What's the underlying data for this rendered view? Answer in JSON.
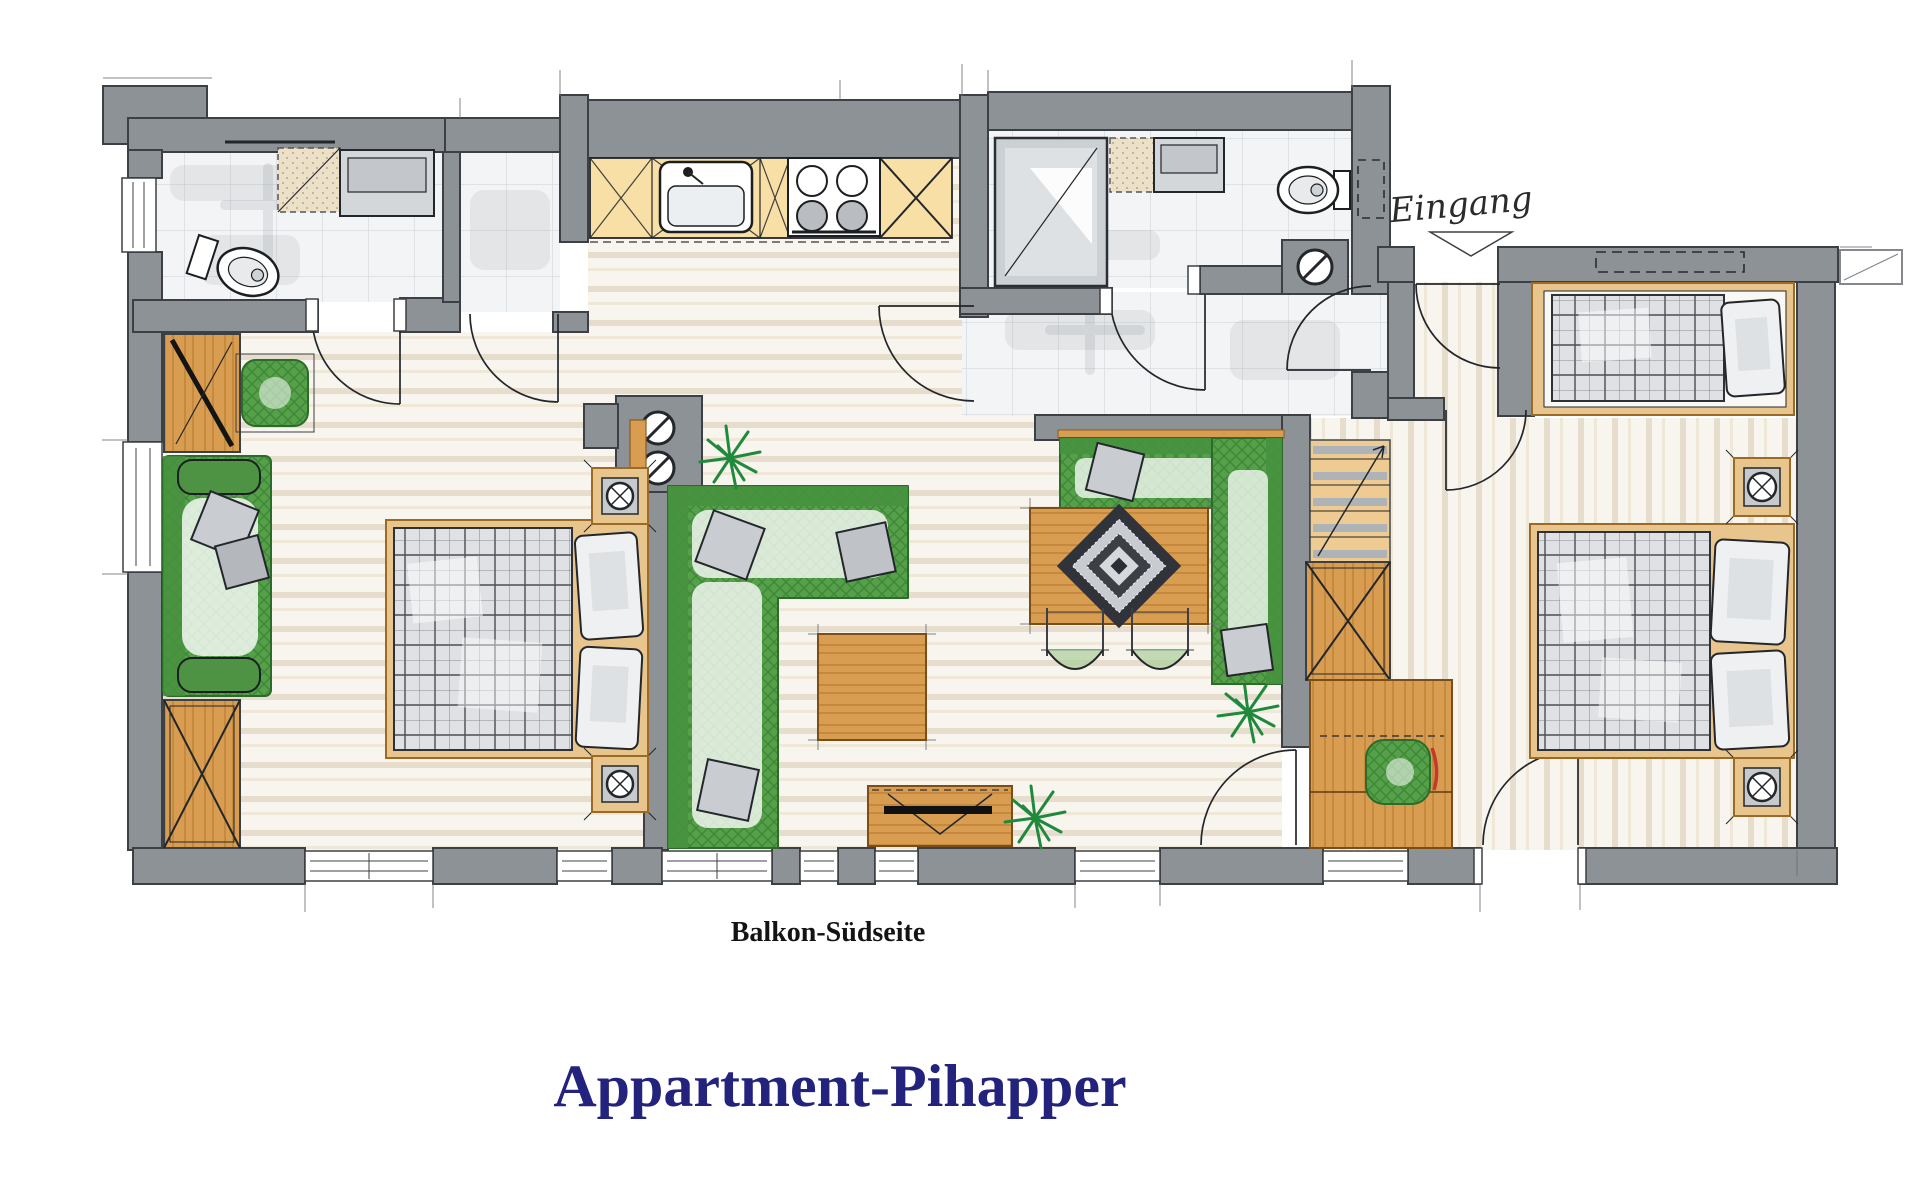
{
  "title": {
    "text": "Appartment-Pihapper",
    "color": "#23237d"
  },
  "labels": {
    "balcony_side": "Balkon-Südseite",
    "entrance": "Eingang"
  },
  "palette": {
    "wall": "#8d9296",
    "wall_outline": "#3c4044",
    "ink": "#23262a",
    "wood": "#d99d52",
    "wood_grain": "#bf8136",
    "wood_frame": "#e9c58e",
    "kitchen_counter": "#f7dfa5",
    "upholstery_green": "#56a04a",
    "upholstery_green_dark": "#3f8a3a",
    "plant_green": "#1f8a3c",
    "floor_cream": "#f8f5ee",
    "floor_stripe": "#e7ddcc",
    "tile": "#f3f4f6",
    "tile_line": "#d7dce1",
    "cushion_gray": "#c9ccd0",
    "quilt_gray": "#dfe1e4",
    "accent_red": "#c13a2d",
    "title_navy": "#23237d"
  },
  "icons": [
    "toilet-icon",
    "sink-icon",
    "stove-burners-icon",
    "shower-icon",
    "washbasin-icon",
    "double-bed-icon",
    "single-bed-icon",
    "pillow-icon",
    "sofa-icon",
    "armchair-icon",
    "wardrobe-icon",
    "nightstand-lamp-icon",
    "dining-table-icon",
    "corner-bench-icon",
    "chair-icon",
    "diamond-rug-icon",
    "coffee-table-icon",
    "tv-sideboard-icon",
    "plant-icon",
    "stairs-icon",
    "door-arc-icon",
    "window-icon",
    "entrance-arrow-icon",
    "column-icon",
    "skylight-icon",
    "duct-icon",
    "desk-icon"
  ]
}
